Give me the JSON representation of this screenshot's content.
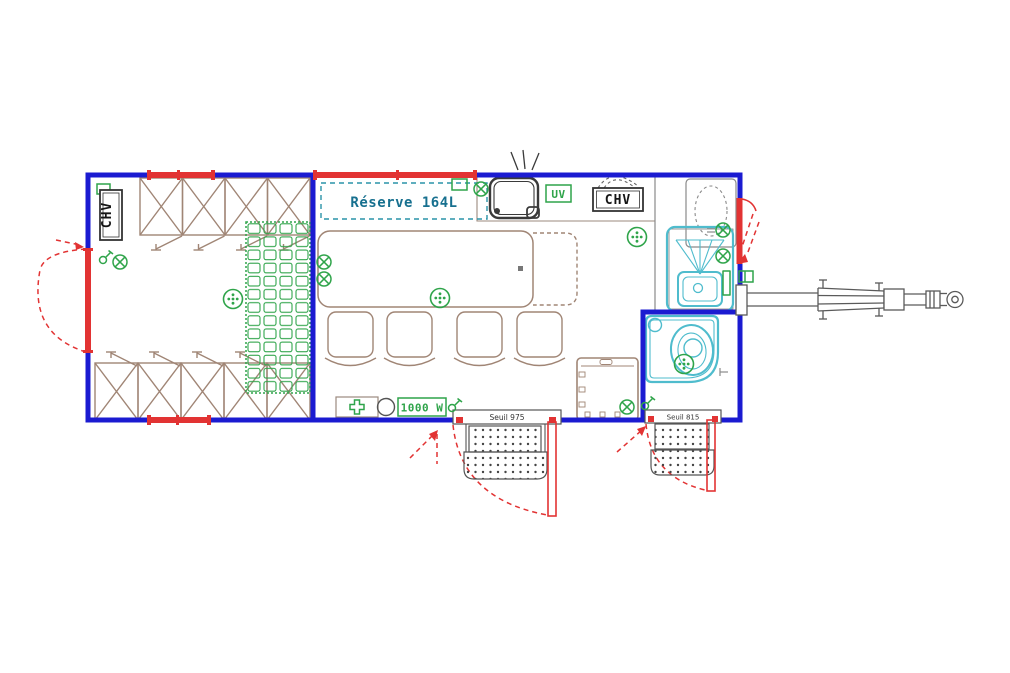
{
  "drawing": {
    "type": "trailer-floor-plan",
    "labels": {
      "left_vent": "CHV",
      "right_vent": "CHV",
      "water_tank": "Réserve 164L",
      "uv_unit": "UV",
      "heater_power": "1000 W",
      "main_door_threshold": "Seuil 975",
      "wc_door_threshold": "Seuil 815"
    },
    "colors": {
      "wall_blue": "#1b1bd1",
      "accent_red": "#e23333",
      "furniture_brown": "#a08575",
      "symbol_green": "#2fa44a",
      "fixture_teal": "#4fbccd",
      "tank_teal": "#2a93a8",
      "tank_text": "#17708f",
      "ink_dark": "#3a3a3a",
      "hitch_gray": "#5a5a5a"
    },
    "symbols": {
      "ceiling_light_icon": "green circle with dots",
      "power_outlet_icon": "green circle with X",
      "switch_icon": "green circle with stem"
    }
  }
}
